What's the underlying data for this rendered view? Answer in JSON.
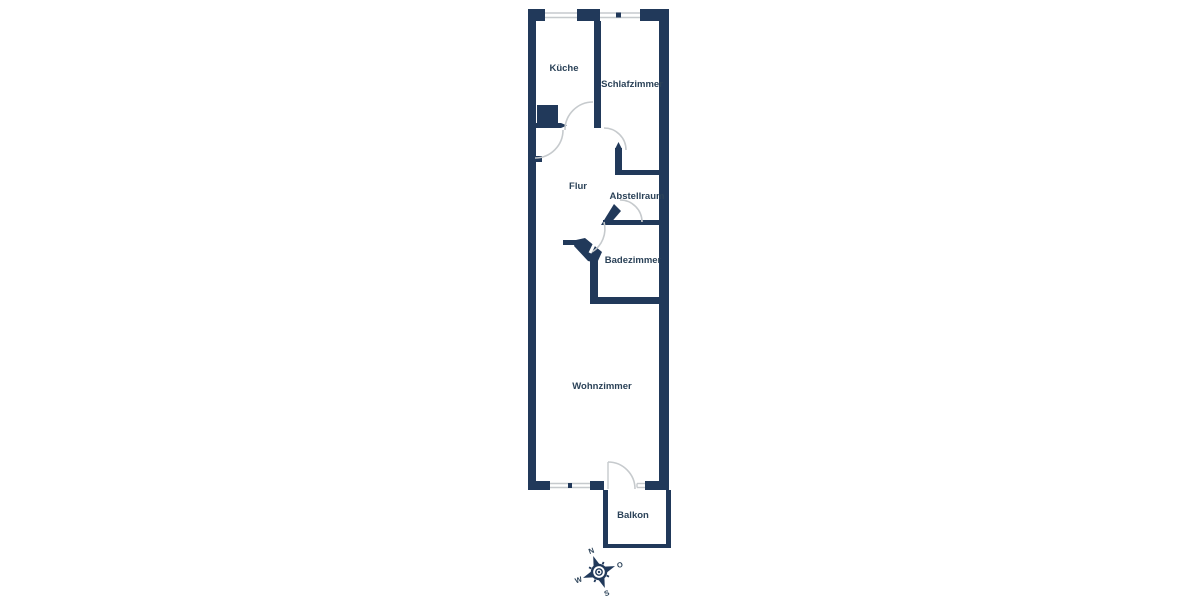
{
  "meta": {
    "type": "floorplan",
    "language": "de"
  },
  "colors": {
    "wall": "#21395A",
    "window": "#C6CACD",
    "label": "#2B4258",
    "background": "#FFFFFF"
  },
  "rooms": [
    {
      "id": "kueche",
      "label": "Küche"
    },
    {
      "id": "schlafzimmer",
      "label": "Schlafzimmer"
    },
    {
      "id": "flur",
      "label": "Flur"
    },
    {
      "id": "abstellraum",
      "label": "Abstellraum"
    },
    {
      "id": "badezimmer",
      "label": "Badezimmer"
    },
    {
      "id": "wohnzimmer",
      "label": "Wohnzimmer"
    },
    {
      "id": "balkon",
      "label": "Balkon"
    }
  ],
  "compass": {
    "north": "N",
    "east": "O",
    "south": "S",
    "west": "W"
  }
}
